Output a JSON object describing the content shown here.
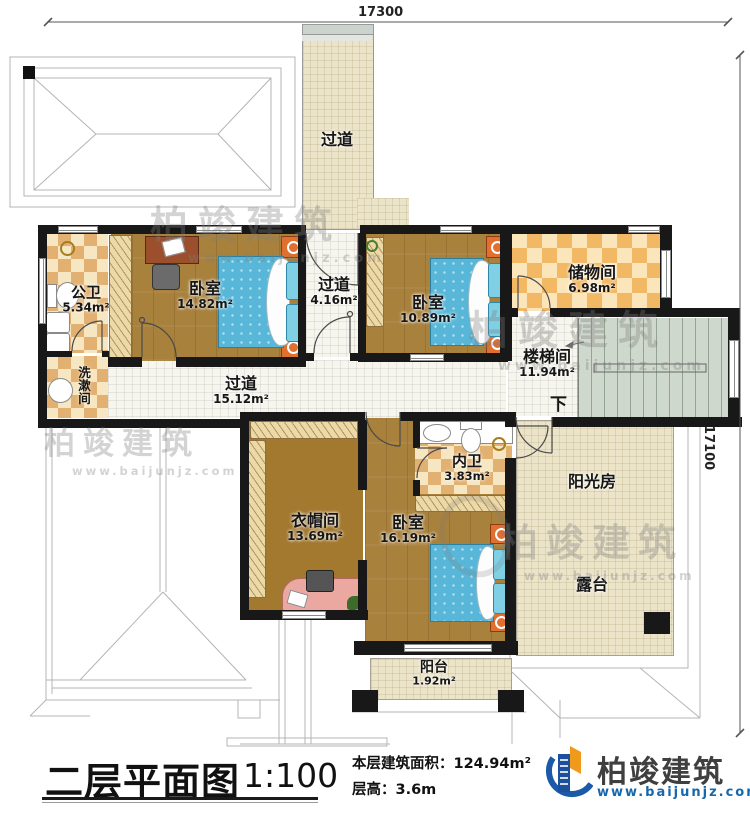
{
  "dimensions": {
    "top": "17300",
    "right": "17100"
  },
  "rooms": [
    {
      "name": "过道",
      "area": ""
    },
    {
      "name": "公卫",
      "area": "5.34m²"
    },
    {
      "name": "卧室",
      "area": "14.82m²"
    },
    {
      "name": "过道",
      "area": "4.16m²"
    },
    {
      "name": "卧室",
      "area": "10.89m²"
    },
    {
      "name": "储物间",
      "area": "6.98m²"
    },
    {
      "name": "楼梯间",
      "area": "11.94m²"
    },
    {
      "name": "洗漱间",
      "area": ""
    },
    {
      "name": "过道",
      "area": "15.12m²"
    },
    {
      "name": "内卫",
      "area": "3.83m²"
    },
    {
      "name": "衣帽间",
      "area": "13.69m²"
    },
    {
      "name": "卧室",
      "area": "16.19m²"
    },
    {
      "name": "阳光房",
      "area": ""
    },
    {
      "name": "露台",
      "area": ""
    },
    {
      "name": "阳台",
      "area": "1.92m²"
    }
  ],
  "stairs": {
    "down_label": "下"
  },
  "title": {
    "name": "二层平面图",
    "scale": "1:100",
    "area_label": "本层建筑面积：",
    "area_value": "124.94m²",
    "floor_height_label": "层高：",
    "floor_height_value": "3.6m"
  },
  "brand": {
    "name": "柏竣建筑",
    "url": "www.baijunjz.com"
  },
  "watermark": {
    "name": "柏竣建筑",
    "url": "www.baijunjz.com"
  },
  "colors": {
    "wall": "#181818",
    "wood_floor": "#a8813d",
    "tile_beige": "#ece4c9",
    "checker_tan": "#e2b172",
    "bed_blue": "#58b7d8",
    "stair_green": "#cfd8cc",
    "logo_blue": "#1a5aa6",
    "logo_orange": "#ef9a1b",
    "url_blue": "#1668ad"
  }
}
